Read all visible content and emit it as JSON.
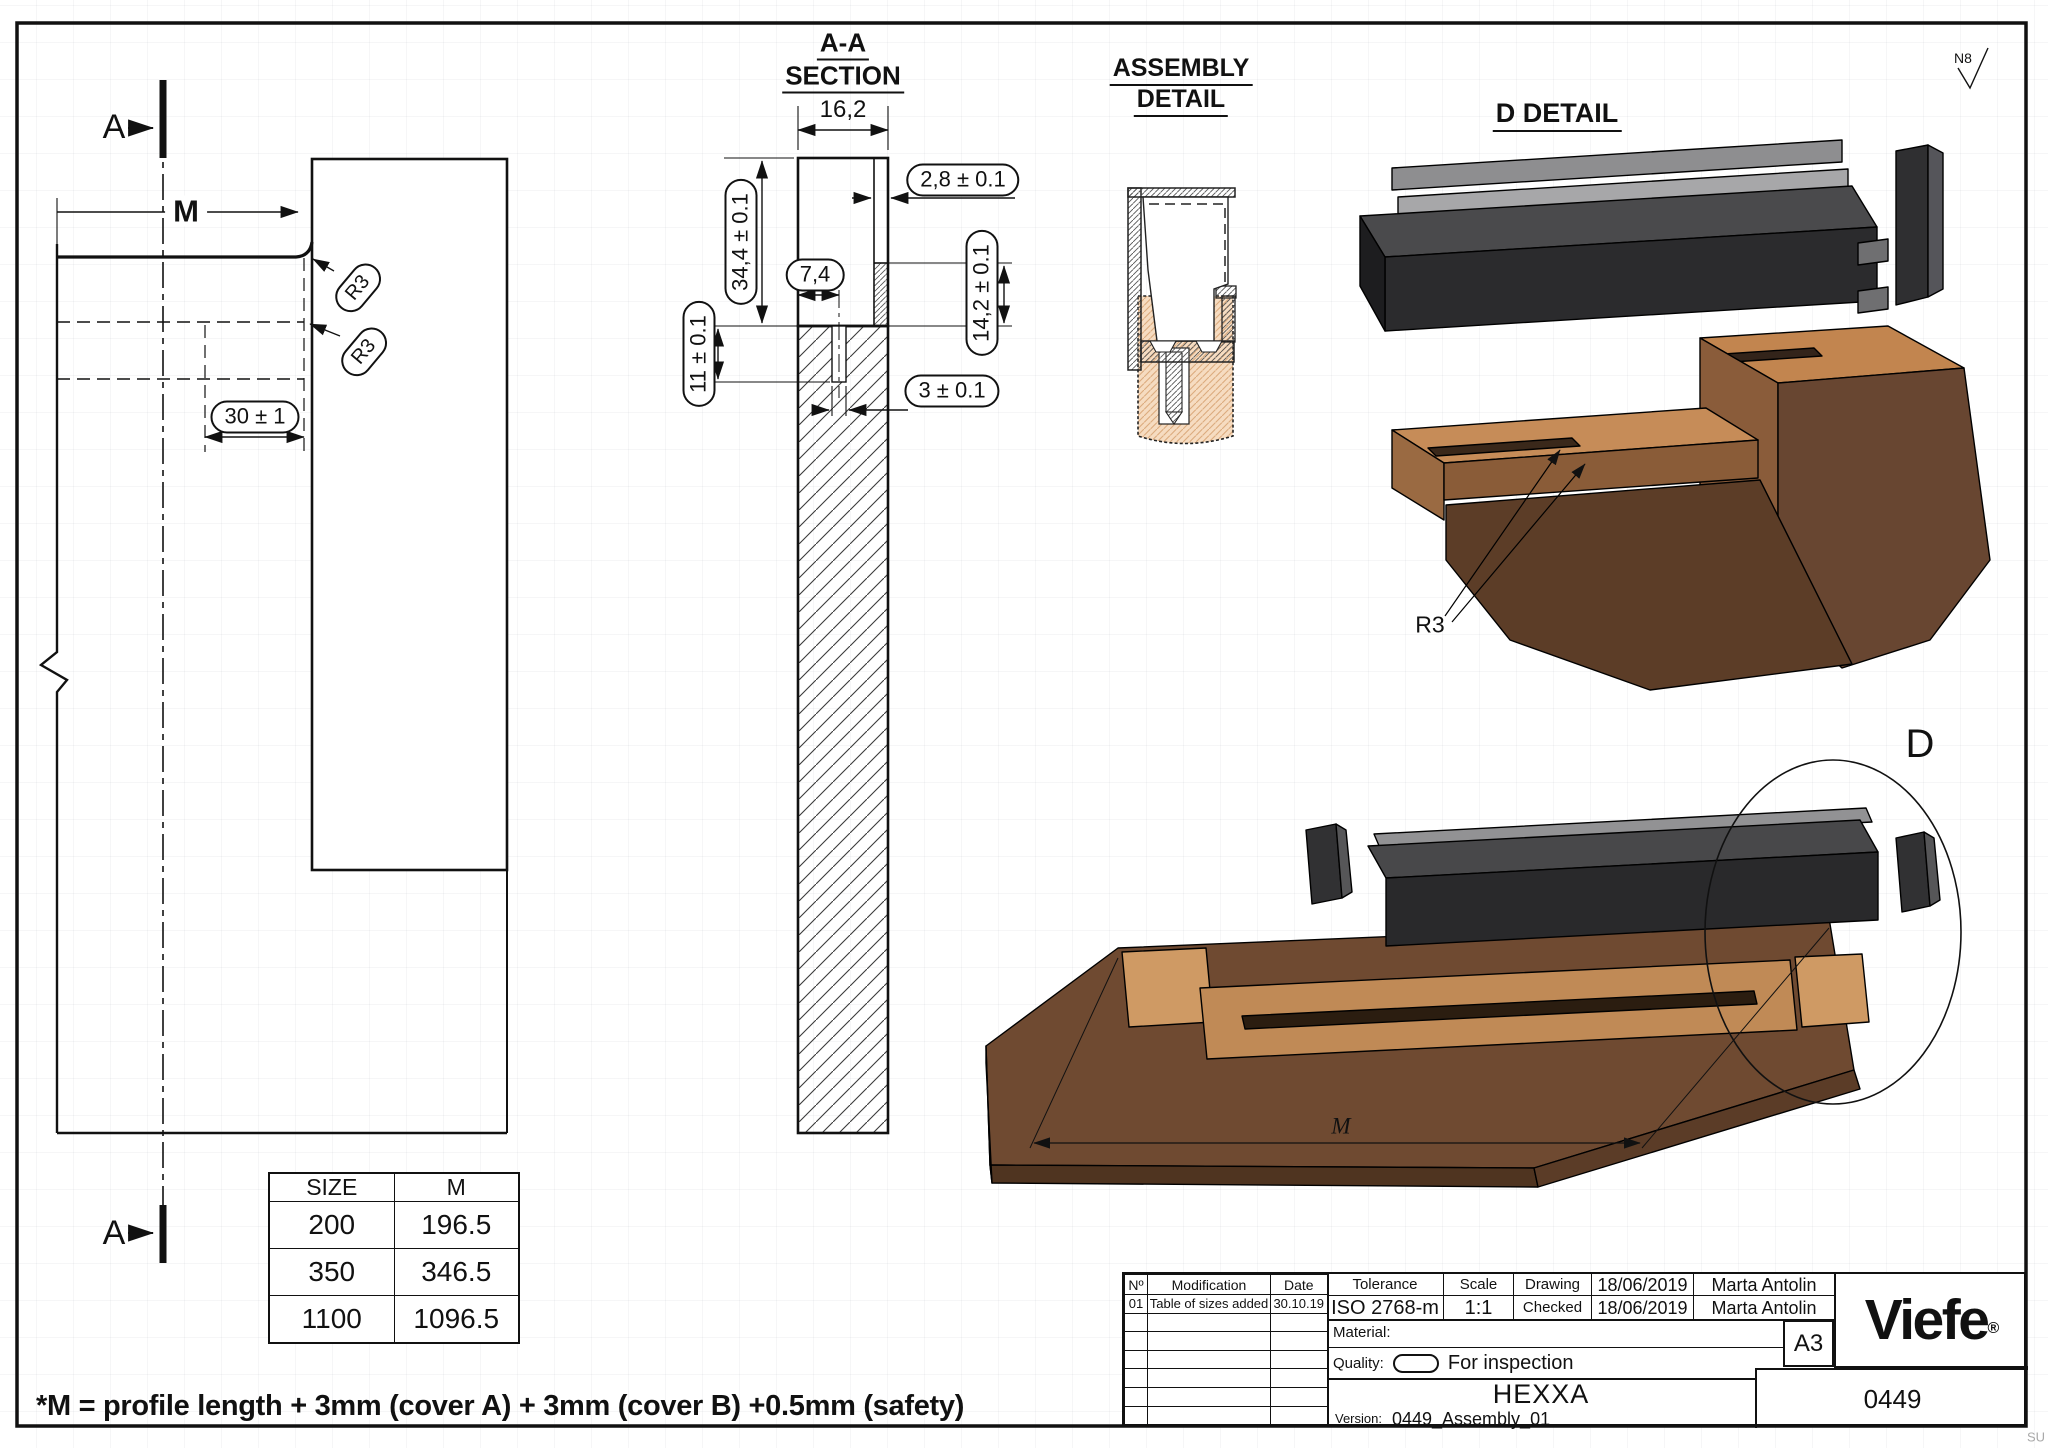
{
  "colors": {
    "paper": "#ffffff",
    "line": "#111111",
    "wood-tan": "#f6dcc1",
    "wood-light": "#cf9a64",
    "wood-mid": "#8a5c3a",
    "wood-dark": "#6f4a31",
    "metal-dark": "#2b2b2d",
    "metal-mid": "#4a4a4c",
    "metal-light": "#a7a7a9"
  },
  "frame": {
    "surface_finish": "N8",
    "watermark": "SU"
  },
  "left_view": {
    "section_a_top": "A",
    "section_a_bottom": "A",
    "m_label": "M",
    "r3_a": "R3",
    "r3_b": "R3",
    "dim_30": "30 ± 1"
  },
  "section": {
    "title1": "A-A",
    "title2": "SECTION",
    "dim_width": "16,2",
    "dim_wall": "2,8 ± 0.1",
    "dim_height": "34,4 ± 0.1",
    "dim_offset": "7,4",
    "dim_step": "14,2 ± 0.1",
    "dim_depth": "11 ± 0.1",
    "dim_slot": "3 ± 0.1"
  },
  "assembly_detail": {
    "title1": "ASSEMBLY",
    "title2": "DETAIL"
  },
  "d_detail": {
    "title": "D DETAIL",
    "r3": "R3"
  },
  "assembly_view": {
    "m_label": "M",
    "circle_label": "D"
  },
  "size_table": {
    "headers": [
      "SIZE",
      "M"
    ],
    "rows": [
      [
        "200",
        "196.5"
      ],
      [
        "350",
        "346.5"
      ],
      [
        "1100",
        "1096.5"
      ]
    ]
  },
  "note": "*M = profile length + 3mm (cover A) + 3mm (cover B) +0.5mm (safety)",
  "title_block": {
    "rev": {
      "col_no": "Nº",
      "col_mod": "Modification",
      "col_date": "Date",
      "r1_no": "01",
      "r1_mod": "Table of sizes added",
      "r1_date": "30.10.19"
    },
    "tolerance_label": "Tolerance",
    "tolerance_value": "ISO 2768-m",
    "scale_label": "Scale",
    "scale_value": "1:1",
    "drawing_label": "Drawing",
    "drawing_date": "18/06/2019",
    "drawing_author": "Marta Antolin",
    "checked_label": "Checked",
    "checked_date": "18/06/2019",
    "checked_author": "Marta Antolin",
    "material_label": "Material:",
    "quality_label": "Quality:",
    "quality_value": "For inspection",
    "paper_size": "A3",
    "logo": "Viefe",
    "logo_reg": "®",
    "product": "HEXXA",
    "version_label": "Version:",
    "version_value": "0449_Assembly_01",
    "number": "0449"
  }
}
